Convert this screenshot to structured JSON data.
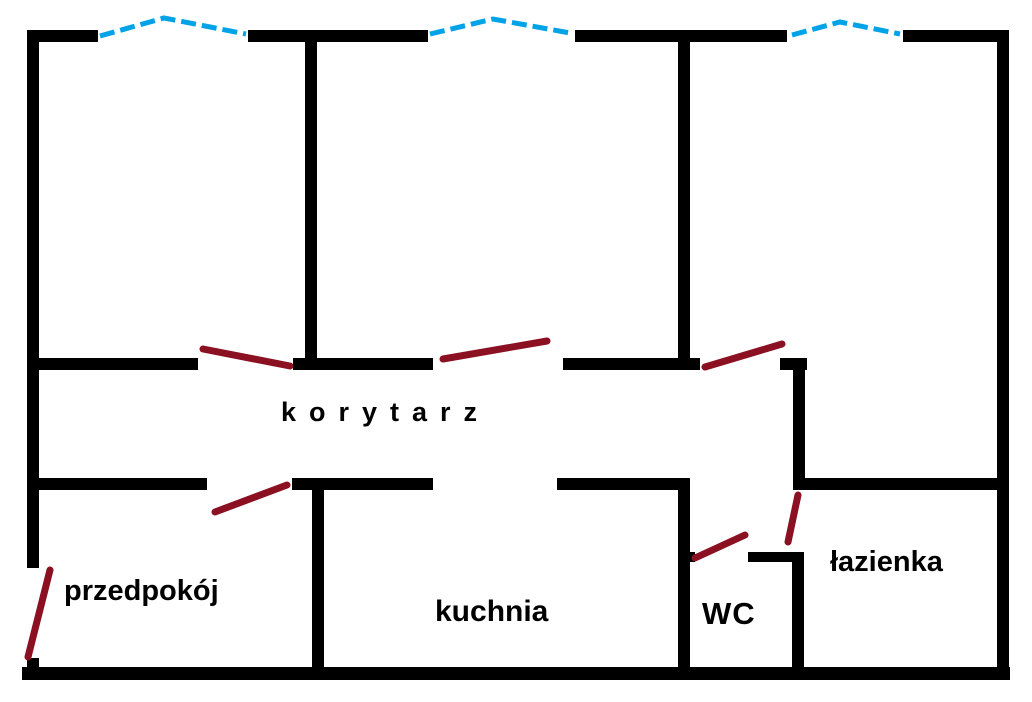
{
  "title": "Apartment floor plan",
  "colors": {
    "background": "#ffffff",
    "wall": "#000000",
    "window_marker": "#00a2e8",
    "door_marker": "#8b1022",
    "label_text": "#000000"
  },
  "rooms": [
    {
      "name": "korytarz",
      "label": "korytarz"
    },
    {
      "name": "przedpokoj",
      "label": "przedpokój"
    },
    {
      "name": "kuchnia",
      "label": "kuchnia"
    },
    {
      "name": "wc",
      "label": "WC"
    },
    {
      "name": "lazienka",
      "label": "łazienka"
    }
  ],
  "plan": {
    "width": 1032,
    "height": 702,
    "wall_segments": [
      {
        "name": "top-wall-segment-1",
        "x": 27,
        "y": 30,
        "w": 71,
        "h": 12
      },
      {
        "name": "top-wall-segment-2",
        "x": 248,
        "y": 30,
        "w": 180,
        "h": 12
      },
      {
        "name": "top-wall-segment-3",
        "x": 575,
        "y": 30,
        "w": 212,
        "h": 12
      },
      {
        "name": "top-wall-segment-4",
        "x": 903,
        "y": 30,
        "w": 104,
        "h": 12
      },
      {
        "name": "left-wall-upper",
        "x": 27,
        "y": 30,
        "w": 12,
        "h": 538
      },
      {
        "name": "left-wall-lower",
        "x": 27,
        "y": 658,
        "w": 12,
        "h": 22
      },
      {
        "name": "right-wall",
        "x": 997,
        "y": 30,
        "w": 12,
        "h": 650
      },
      {
        "name": "bottom-wall",
        "x": 22,
        "y": 667,
        "w": 988,
        "h": 13
      },
      {
        "name": "room-divider-1",
        "x": 305,
        "y": 30,
        "w": 12,
        "h": 333
      },
      {
        "name": "room-divider-2",
        "x": 678,
        "y": 30,
        "w": 12,
        "h": 340
      },
      {
        "name": "corridor-top-segment-1",
        "x": 27,
        "y": 358,
        "w": 171,
        "h": 12
      },
      {
        "name": "corridor-top-segment-2",
        "x": 293,
        "y": 358,
        "w": 140,
        "h": 12
      },
      {
        "name": "corridor-top-segment-3",
        "x": 563,
        "y": 358,
        "w": 137,
        "h": 12
      },
      {
        "name": "corridor-top-segment-4",
        "x": 780,
        "y": 358,
        "w": 27,
        "h": 12
      },
      {
        "name": "bathroom-left-wall-upper",
        "x": 793,
        "y": 358,
        "w": 12,
        "h": 132
      },
      {
        "name": "corridor-bottom-segment-1",
        "x": 27,
        "y": 478,
        "w": 180,
        "h": 12
      },
      {
        "name": "corridor-bottom-segment-2",
        "x": 292,
        "y": 478,
        "w": 141,
        "h": 12
      },
      {
        "name": "corridor-bottom-segment-3",
        "x": 557,
        "y": 478,
        "w": 133,
        "h": 12
      },
      {
        "name": "bathroom-top-wall",
        "x": 797,
        "y": 478,
        "w": 212,
        "h": 12
      },
      {
        "name": "kitchen-left-wall",
        "x": 312,
        "y": 478,
        "w": 12,
        "h": 200
      },
      {
        "name": "kitchen-right-wall",
        "x": 678,
        "y": 478,
        "w": 12,
        "h": 200
      },
      {
        "name": "wc-top-wall-left",
        "x": 678,
        "y": 552,
        "w": 17,
        "h": 10
      },
      {
        "name": "wc-top-wall-right",
        "x": 748,
        "y": 552,
        "w": 56,
        "h": 10
      },
      {
        "name": "wc-right-wall",
        "x": 792,
        "y": 552,
        "w": 12,
        "h": 126
      }
    ],
    "windows": [
      {
        "name": "window-room-1",
        "points": [
          [
            100,
            36
          ],
          [
            164,
            18
          ],
          [
            246,
            34
          ]
        ]
      },
      {
        "name": "window-room-2",
        "points": [
          [
            430,
            34
          ],
          [
            493,
            19
          ],
          [
            570,
            33
          ]
        ]
      },
      {
        "name": "window-room-3",
        "points": [
          [
            792,
            35
          ],
          [
            840,
            22
          ],
          [
            900,
            34
          ]
        ]
      }
    ],
    "doors": [
      {
        "name": "door-room-1",
        "x1": 203,
        "y1": 349,
        "x2": 290,
        "y2": 366
      },
      {
        "name": "door-room-2",
        "x1": 443,
        "y1": 359,
        "x2": 547,
        "y2": 341
      },
      {
        "name": "door-room-3",
        "x1": 705,
        "y1": 367,
        "x2": 782,
        "y2": 344
      },
      {
        "name": "door-przedpokoj",
        "x1": 215,
        "y1": 512,
        "x2": 287,
        "y2": 485
      },
      {
        "name": "door-entrance",
        "x1": 50,
        "y1": 570,
        "x2": 28,
        "y2": 657
      },
      {
        "name": "door-wc",
        "x1": 695,
        "y1": 558,
        "x2": 745,
        "y2": 535
      },
      {
        "name": "door-lazienka",
        "x1": 798,
        "y1": 495,
        "x2": 788,
        "y2": 542
      }
    ]
  }
}
